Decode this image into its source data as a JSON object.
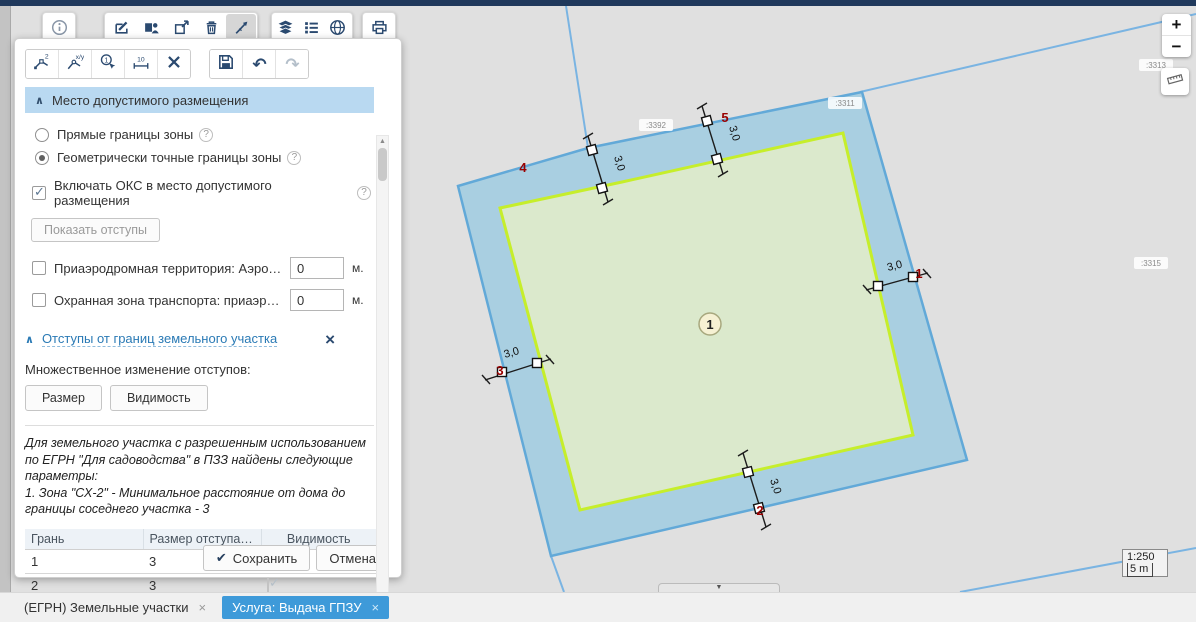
{
  "icons": {
    "close": "×",
    "check": "✔",
    "chevron_up": "∧",
    "help": "?",
    "undo": "↶",
    "redo": "↷",
    "scroll_up": "▲",
    "scroll_down": "▼",
    "collapse": "▼"
  },
  "top_toolbar": {
    "tools": [
      "info",
      "edit",
      "select-object",
      "open-in-window",
      "delete",
      "measure",
      "layers",
      "legend",
      "basemap",
      "print"
    ],
    "active_tool": "measure"
  },
  "sketch_toolbar": {
    "tools": [
      "add-vertex",
      "edit-coordinates",
      "select-contour",
      "dimensions",
      "delete-sketch",
      "save",
      "undo",
      "redo"
    ],
    "glyphs": {
      "vertex": "2",
      "xy": "x/y",
      "contour": "1",
      "dim": "10"
    }
  },
  "panel": {
    "placement": {
      "title": "Место допустимого размещения",
      "options": [
        {
          "label": "Прямые границы зоны",
          "selected": false
        },
        {
          "label": "Геометрически точные границы зоны",
          "selected": true
        }
      ],
      "include_oks": {
        "label": "Включать ОКС в место допустимого размещения",
        "checked": true
      },
      "show_setbacks_btn": "Показать отступы",
      "zones": [
        {
          "label": "Приаэродромная территория: Аэродром а...",
          "value": "0",
          "unit": "м.",
          "checked": false
        },
        {
          "label": "Охранная зона транспорта: приаэродром...",
          "value": "0",
          "unit": "м.",
          "checked": false
        }
      ]
    },
    "setbacks": {
      "title": "Отступы от границ земельного участка",
      "multi_edit_label": "Множественное изменение отступов:",
      "size_btn": "Размер",
      "visibility_btn": "Видимость",
      "note_lines": [
        "Для земельного участка с разрешенным использованием",
        "по ЕГРН \"Для садоводства\" в ПЗЗ найдены следующие",
        "параметры:",
        "1. Зона \"СХ-2\" - Минимальное расстояние от дома до",
        "границы соседнего участка - 3"
      ],
      "table": {
        "headers": [
          "Грань",
          "Размер отступа…",
          "Видимость"
        ],
        "rows": [
          {
            "face": "1",
            "size": "3",
            "visible": true
          },
          {
            "face": "2",
            "size": "3",
            "visible": true
          }
        ]
      },
      "save_btn": "Сохранить",
      "cancel_btn": "Отмена"
    }
  },
  "map": {
    "controls": {
      "zoom_in": "+",
      "zoom_out": "−",
      "scale_ratio": "1:250",
      "scale_bar": "5 m"
    },
    "parcel_labels": [
      ":3392",
      ":3311",
      ":3313",
      ":3315"
    ],
    "edge_numbers": [
      "1",
      "2",
      "3",
      "4",
      "5"
    ],
    "setback_label": "3,0",
    "center_marker": "1",
    "colors": {
      "parcel_fill": "#a9cfe1",
      "parcel_stroke": "#62a9d8",
      "zone_fill": "#dbe9cc",
      "zone_stroke": "#c6ee2b",
      "edge_number": "#990000"
    }
  },
  "tabs": [
    {
      "label": "(ЕГРН) Земельные участки",
      "active": false
    },
    {
      "label": "Услуга: Выдача ГПЗУ",
      "active": true
    }
  ]
}
